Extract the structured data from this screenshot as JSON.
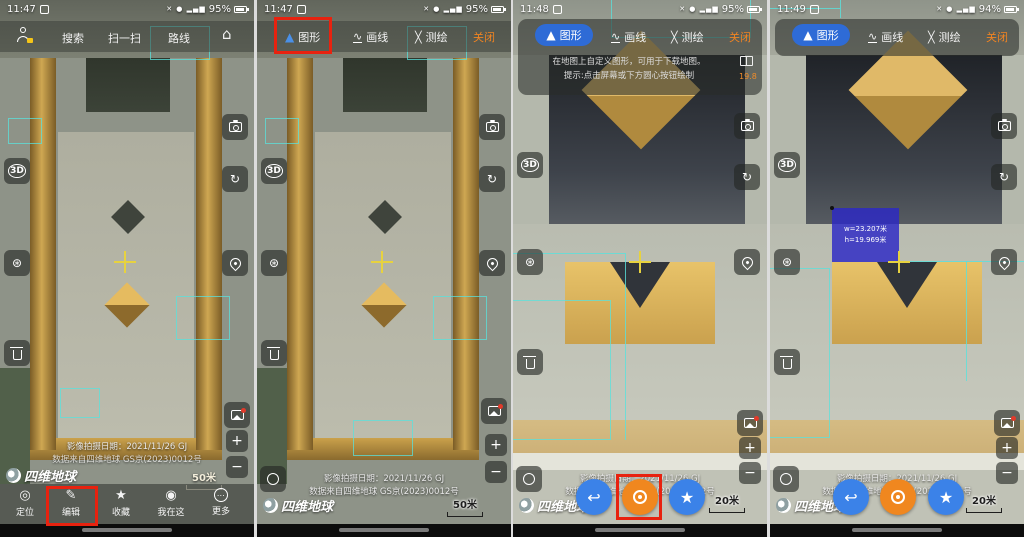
{
  "colors": {
    "accent_blue": "#3b82e8",
    "accent_orange": "#f0871f",
    "highlight_red": "#e8220f",
    "pill_blue": "#2e6bd6",
    "crosshair_yellow": "#e7d23f",
    "measure_blue": "#2c28c6"
  },
  "controls": {
    "zoom_in": "+",
    "zoom_out": "−",
    "three_d": "3D"
  },
  "p1": {
    "status": {
      "time": "11:47",
      "battery": "95%"
    },
    "topbar": {
      "search": "搜索",
      "scan": "扫一扫",
      "route": "路线"
    },
    "map_info": {
      "date": "影像拍摄日期：2021/11/26 GJ",
      "source": "数据来自四维地球 GS京(2023)0012号"
    },
    "logo": "四维地球",
    "scale": "50米",
    "nav": {
      "locate": "定位",
      "edit": "编辑",
      "favorite": "收藏",
      "here": "我在这",
      "more": "更多"
    }
  },
  "p2": {
    "status": {
      "time": "11:47",
      "battery": "95%"
    },
    "toolbar": {
      "shape": "图形",
      "line": "画线",
      "survey": "测绘",
      "close": "关闭"
    },
    "map_info": {
      "date": "影像拍摄日期：2021/11/26 GJ",
      "source": "数据来自四维地球 GS京(2023)0012号"
    },
    "logo": "四维地球",
    "scale": "50米"
  },
  "p3": {
    "status": {
      "time": "11:48",
      "battery": "95%"
    },
    "toolbar": {
      "shape": "图形",
      "line": "画线",
      "survey": "测绘",
      "close": "关闭"
    },
    "hint": {
      "line1": "在地图上自定义图形，可用于下载地图。",
      "line2": "提示:点击屏幕或下方圆心按钮绘制"
    },
    "zoom_level": "19.8",
    "map_info": {
      "date": "影像拍摄日期：2021/11/26 GJ",
      "source": "数据来自四维地球 GS京(2023)0012号"
    },
    "logo": "四维地球",
    "scale": "20米"
  },
  "p4": {
    "status": {
      "time": "11:49",
      "battery": "94%"
    },
    "toolbar": {
      "shape": "图形",
      "line": "画线",
      "survey": "测绘",
      "close": "关闭"
    },
    "measurement": {
      "width": "w=23.207米",
      "height": "h=19.969米"
    },
    "map_info": {
      "date": "影像拍摄日期：2021/11/26 GJ",
      "source": "数据来自四维地球 GS京(2023)0012号"
    },
    "logo": "四维地球",
    "scale": "20米"
  }
}
